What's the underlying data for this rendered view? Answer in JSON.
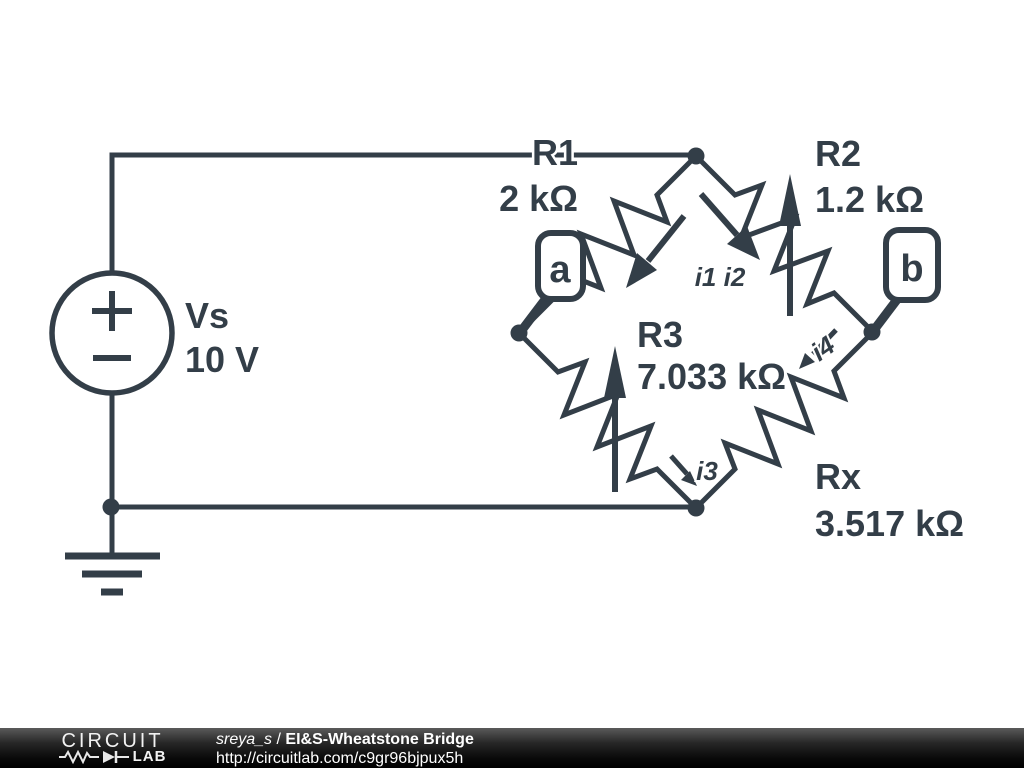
{
  "schematic": {
    "stroke_color": "#333e48",
    "source": {
      "name": "Vs",
      "value": "10 V"
    },
    "resistors": [
      {
        "id": "R1",
        "name": "R1",
        "value": "2 kΩ"
      },
      {
        "id": "R2",
        "name": "R2",
        "value": "1.2 kΩ"
      },
      {
        "id": "R3",
        "name": "R3",
        "value": "7.033 kΩ"
      },
      {
        "id": "Rx",
        "name": "Rx",
        "value": "3.517 kΩ"
      }
    ],
    "node_flags": [
      {
        "label": "a"
      },
      {
        "label": "b"
      }
    ],
    "currents": [
      {
        "label": "i1 i2"
      },
      {
        "label": "i3"
      },
      {
        "label": "i4"
      }
    ]
  },
  "footer": {
    "logo_line1": "CIRCUIT",
    "logo_line2": "LAB",
    "author": "sreya_s",
    "separator": "/",
    "title": "EI&S-Wheatstone Bridge",
    "url": "http://circuitlab.com/c9gr96bjpux5h"
  }
}
